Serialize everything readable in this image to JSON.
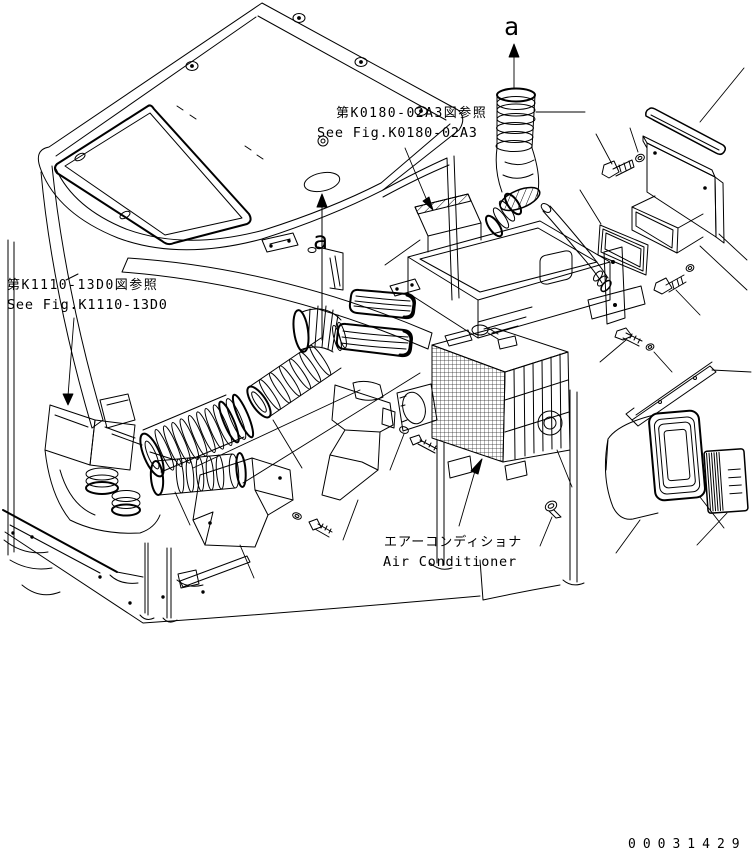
{
  "figure": {
    "colors": {
      "ink": "#000000",
      "paper": "#ffffff"
    },
    "references": {
      "top_jp": "第K0180-02A3図参照",
      "top_en": "See Fig.K0180-02A3",
      "left_jp": "第K1110-13D0図参照",
      "left_en": "See Fig.K1110-13D0"
    },
    "component": {
      "name_jp": "エアーコンディショナ",
      "name_en": "Air Conditioner"
    },
    "section_arrows": {
      "top": "a",
      "side": "a"
    },
    "drawing_number": "00031429"
  }
}
